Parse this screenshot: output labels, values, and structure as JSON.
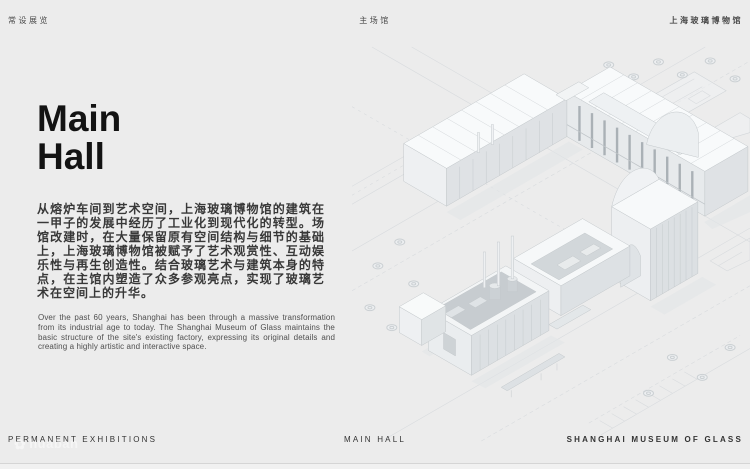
{
  "header": {
    "left": "常设展览",
    "center": "主场馆",
    "right": "上海玻璃博物馆"
  },
  "hero": {
    "title_line1": "Main",
    "title_line2": "Hall"
  },
  "body_zh": "从熔炉车间到艺术空间，上海玻璃博物馆的建筑在一甲子的发展中经历了工业化到现代化的转型。场馆改建时，在大量保留原有空间结构与细节的基础上，上海玻璃博物馆被赋予了艺术观赏性、互动娱乐性与再生创造性。结合玻璃艺术与建筑本身的特点，在主馆内塑造了众多参观亮点，实现了玻璃艺术在空间上的升华。",
  "body_en": "Over the past 60 years, Shanghai has been through a massive transformation from its industrial age to today. The Shanghai Museum of Glass maintains the basic structure of the site's existing factory, expressing its original details and creating a highly artistic and interactive space.",
  "footer": {
    "left": "PERMANENT EXHIBITIONS",
    "center": "MAIN HALL",
    "right": "SHANGHAI MUSEUM OF GLASS"
  },
  "watermark": {
    "flower_icon": "✿",
    "text": "huaban"
  },
  "illustration": {
    "alt": "Isometric cutaway architectural rendering of the Shanghai Museum of Glass main hall on a faint site plan"
  },
  "colors": {
    "page_bg": "#ececec",
    "title_text": "#131313",
    "body_text": "#383838",
    "accent_none": ""
  }
}
